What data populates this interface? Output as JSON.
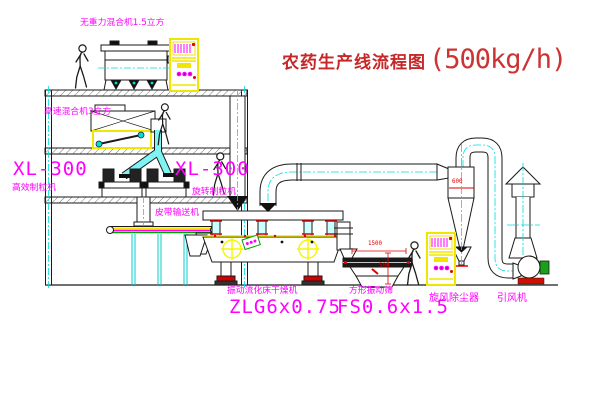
{
  "title": {
    "text": "农药生产线流程图",
    "capacity": "(500kg/h)"
  },
  "equipment": {
    "gravity_mixer": "无重力混合机1.5立方",
    "high_speed_mixer": "高速混合机3立方",
    "granulator_left_model": "XL-300",
    "granulator_left_name": "高效制粒机",
    "granulator_right_model": "XL-300",
    "granulator_right_name": "旋转制粒机",
    "belt_conveyor": "皮带输送机",
    "dryer_name": "振动流化床干燥机",
    "dryer_model": "ZLG6x0.75",
    "sieve_name": "方形振动筛",
    "sieve_model": "FS0.6x1.5",
    "cyclone": "旋风除尘器",
    "fan": "引风机"
  },
  "dimensions": {
    "sieve_length": "1500",
    "cyclone_outlet": "600",
    "sieve_height": "500"
  },
  "colors": {
    "label": "#FF00FF",
    "title": "#C62828",
    "dim": "#E00000",
    "centerline": "#00DDDD",
    "cabinet": "#F0E600",
    "line": "#1a1a1a"
  }
}
